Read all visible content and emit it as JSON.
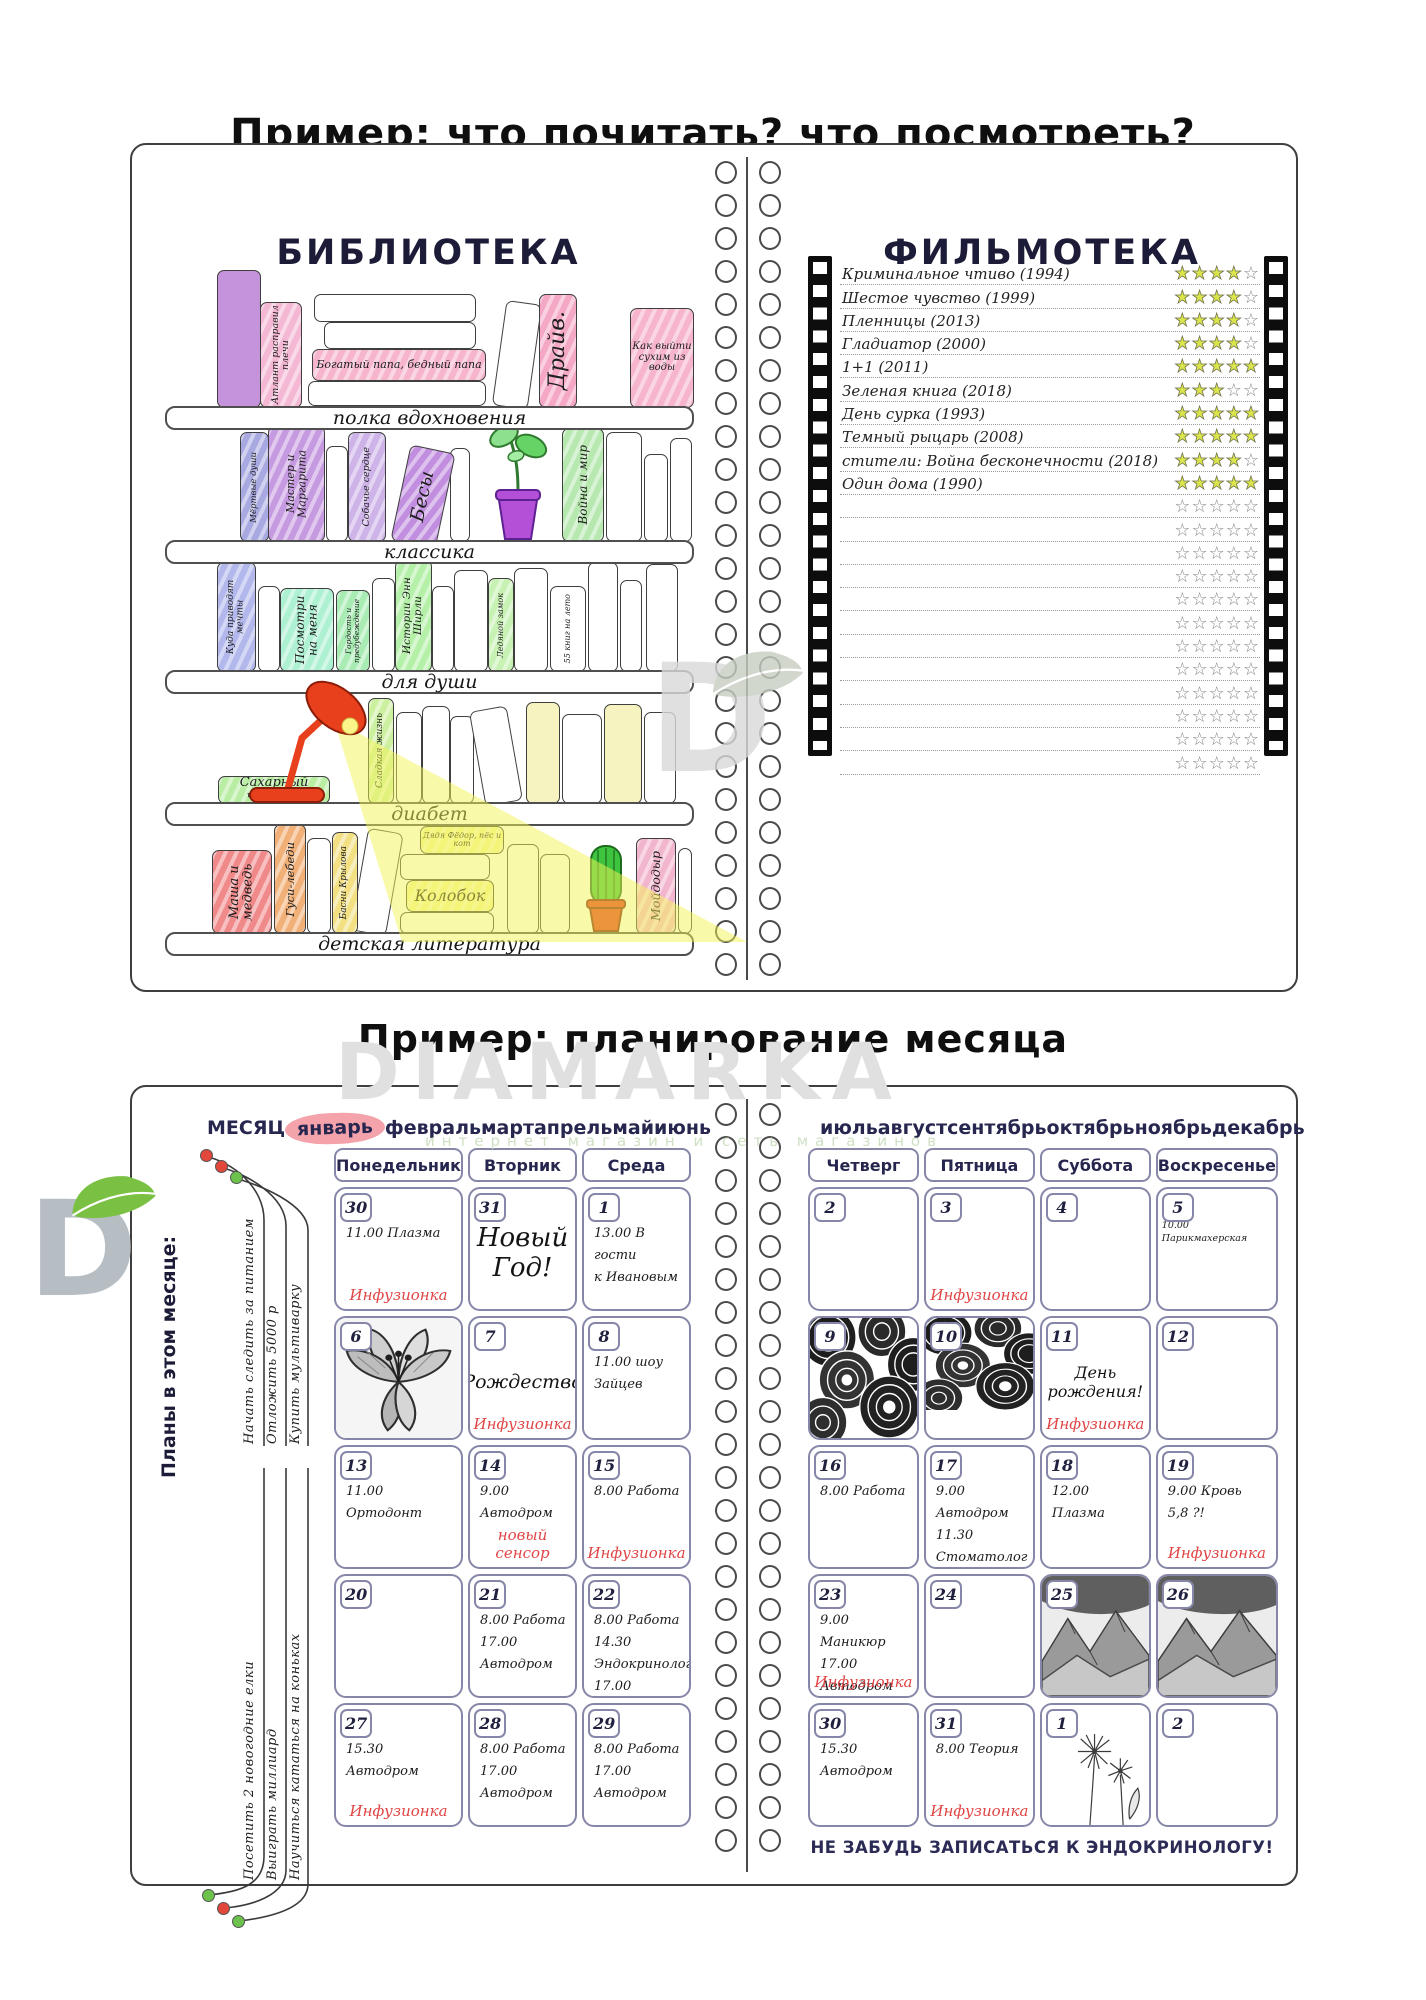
{
  "page_titles": {
    "reading": "Пример: что почитать? что посмотреть?",
    "planning": "Пример: планирование месяца"
  },
  "watermark": {
    "brand": "DIAMARKA",
    "tagline": "интернет магазин и сеть магазинов",
    "logo_letter": "D",
    "leaf_color": "#7ac143"
  },
  "library": {
    "title": "БИБЛИОТЕКА",
    "shelf_labels": [
      "полка вдохновения",
      "классика",
      "для души",
      "диабет",
      "детская литература"
    ],
    "books": [
      {
        "title": "Атлант расправил плечи",
        "color": "#f4b8d4",
        "shelf": 0
      },
      {
        "title": "Богатый папа, бедный папа",
        "color": "#f6b5cd",
        "shelf": 0
      },
      {
        "title": "Драйв.",
        "color": "#f5a8c6",
        "shelf": 0
      },
      {
        "title": "Как выйти сухим из воды",
        "color": "#f6b5cd",
        "shelf": 0
      },
      {
        "title": "Мёртвые души",
        "color": "#a9a9e2",
        "shelf": 1
      },
      {
        "title": "Мастер и Маргарита",
        "color": "#c69ae0",
        "shelf": 1
      },
      {
        "title": "Собачье сердце",
        "color": "#cdb3e8",
        "shelf": 1
      },
      {
        "title": "Бесы",
        "color": "#c28fe0",
        "shelf": 1
      },
      {
        "title": "Война и мир",
        "color": "#b7e8b0",
        "shelf": 1
      },
      {
        "title": "Куда приводят мечты",
        "color": "#b3b8ec",
        "shelf": 2
      },
      {
        "title": "Посмотри на меня",
        "color": "#aef0d2",
        "shelf": 2
      },
      {
        "title": "Гордость и предубеждение",
        "color": "#a8ecb4",
        "shelf": 2
      },
      {
        "title": "Истории Энн Ширли",
        "color": "#b4f0a8",
        "shelf": 2
      },
      {
        "title": "Ледяной замок",
        "color": "#c8f2b4",
        "shelf": 2
      },
      {
        "title": "55 книг на лето",
        "color": "#ffffff",
        "shelf": 2
      },
      {
        "title": "Сахарный человек",
        "color": "#b9eda4",
        "shelf": 3
      },
      {
        "title": "Сладкая жизнь",
        "color": "#cdf0a0",
        "shelf": 3
      },
      {
        "title": "Маша и медведь",
        "color": "#f08a8a",
        "shelf": 4
      },
      {
        "title": "Гуси-лебеди",
        "color": "#f2b079",
        "shelf": 4
      },
      {
        "title": "Басни Крылова",
        "color": "#f2e083",
        "shelf": 4
      },
      {
        "title": "Дядя Фёдор, пёс и кот",
        "color": "#f4f49a",
        "shelf": 4
      },
      {
        "title": "Колобок",
        "color": "#f4f49a",
        "shelf": 4
      },
      {
        "title": "Мойдодыр",
        "color": "#f2b5ce",
        "shelf": 4
      }
    ]
  },
  "filmoteka": {
    "title": "ФИЛЬМОТЕКА",
    "max_stars": 5,
    "star_color": "#d9e54b",
    "empty_rows": 12,
    "films": [
      {
        "title": "Криминальное чтиво (1994)",
        "stars": 4
      },
      {
        "title": "Шестое чувство (1999)",
        "stars": 4
      },
      {
        "title": "Пленницы (2013)",
        "stars": 4
      },
      {
        "title": "Гладиатор (2000)",
        "stars": 4
      },
      {
        "title": "1+1 (2011)",
        "stars": 5
      },
      {
        "title": "Зеленая книга (2018)",
        "stars": 3
      },
      {
        "title": "День сурка (1993)",
        "stars": 5
      },
      {
        "title": "Темный рыцарь (2008)",
        "stars": 5
      },
      {
        "title": "стители: Война бесконечности (2018)",
        "stars": 4
      },
      {
        "title": "Один дома (1990)",
        "stars": 5
      }
    ]
  },
  "planner": {
    "month_word": "МЕСЯЦ",
    "months_left": [
      "январь",
      "февраль",
      "март",
      "апрель",
      "май",
      "июнь"
    ],
    "months_right": [
      "июль",
      "август",
      "сентябрь",
      "октябрь",
      "ноябрь",
      "декабрь"
    ],
    "highlighted_month": "январь",
    "highlight_color": "#f4a3ab",
    "accent_color": "#e04545",
    "day_headers_left": [
      "Понедельник",
      "Вторник",
      "Среда"
    ],
    "day_headers_right": [
      "Четверг",
      "Пятница",
      "Суббота",
      "Воскресенье"
    ],
    "sidebar": {
      "title": "Планы в этом месяце:",
      "goals_top": [
        {
          "text": "Начать следить за питанием",
          "dot": "#e2473c"
        },
        {
          "text": "Отложить 5000 р",
          "dot": "#e2473c"
        },
        {
          "text": "Купить мультиварку",
          "dot": "#6cc24a"
        }
      ],
      "goals_bottom": [
        {
          "text": "Посетить 2 новогодние елки",
          "dot": "#6cc24a"
        },
        {
          "text": "Выиграть миллиард",
          "dot": "#e2473c"
        },
        {
          "text": "Научиться кататься на коньках",
          "dot": "#6cc24a"
        }
      ]
    },
    "weeks_left": [
      [
        {
          "day": "30",
          "entries": [
            "11.00 Плазма"
          ],
          "accent": "Инфузионка"
        },
        {
          "day": "31",
          "big": "Новый\nГод!"
        },
        {
          "day": "1",
          "entries": [
            "13.00 В гости",
            "к Ивановым"
          ]
        }
      ],
      [
        {
          "day": "6",
          "image": "flower"
        },
        {
          "day": "7",
          "big": "Рождество",
          "accent": "Инфузионка"
        },
        {
          "day": "8",
          "entries": [
            "11.00 шоу Зайцев"
          ]
        }
      ],
      [
        {
          "day": "13",
          "entries": [
            "11.00 Ортодонт"
          ]
        },
        {
          "day": "14",
          "entries": [
            "9.00 Автодром"
          ],
          "accent": "новый сенсор"
        },
        {
          "day": "15",
          "entries": [
            "8.00 Работа"
          ],
          "accent": "Инфузионка"
        }
      ],
      [
        {
          "day": "20"
        },
        {
          "day": "21",
          "entries": [
            "8.00 Работа",
            "17.00 Автодром"
          ]
        },
        {
          "day": "22",
          "entries": [
            "8.00 Работа",
            "14.30 Эндокринолог",
            "17.00 Автодром"
          ]
        }
      ],
      [
        {
          "day": "27",
          "entries": [
            "15.30 Автодром"
          ],
          "accent": "Инфузионка"
        },
        {
          "day": "28",
          "entries": [
            "8.00 Работа",
            "17.00 Автодром"
          ]
        },
        {
          "day": "29",
          "entries": [
            "8.00 Работа",
            "17.00 Автодром"
          ]
        }
      ]
    ],
    "weeks_right": [
      [
        {
          "day": "2"
        },
        {
          "day": "3",
          "accent": "Инфузионка"
        },
        {
          "day": "4"
        },
        {
          "day": "5",
          "entries": [
            "10.00 Парикмахерская"
          ],
          "small": true
        }
      ],
      [
        {
          "day": "9",
          "image": "pattern"
        },
        {
          "day": "10",
          "image": "pattern_partial"
        },
        {
          "day": "11",
          "big": "День\nрождения!",
          "accent": "Инфузионка"
        },
        {
          "day": "12"
        }
      ],
      [
        {
          "day": "16",
          "entries": [
            "8.00 Работа"
          ]
        },
        {
          "day": "17",
          "entries": [
            "9.00 Автодром",
            "11.30 Стоматолог"
          ]
        },
        {
          "day": "18",
          "entries": [
            "12.00 Плазма"
          ]
        },
        {
          "day": "19",
          "entries": [
            "9.00 Кровь",
            "5,8 ?!"
          ],
          "accent": "Инфузионка"
        }
      ],
      [
        {
          "day": "23",
          "entries": [
            "9.00 Маникюр",
            "17.00 Автодром"
          ],
          "accent": "Инфузионка"
        },
        {
          "day": "24"
        },
        {
          "day": "25",
          "image": "mountains"
        },
        {
          "day": "26",
          "image": "mountains"
        }
      ],
      [
        {
          "day": "30",
          "entries": [
            "15.30 Автодром"
          ]
        },
        {
          "day": "31",
          "entries": [
            "8.00 Теория"
          ],
          "accent": "Инфузионка"
        },
        {
          "day": "1",
          "image": "dandelion"
        },
        {
          "day": "2"
        }
      ]
    ],
    "footer_note": "НЕ ЗАБУДЬ ЗАПИСАТЬСЯ К ЭНДОКРИНОЛОГУ!"
  }
}
